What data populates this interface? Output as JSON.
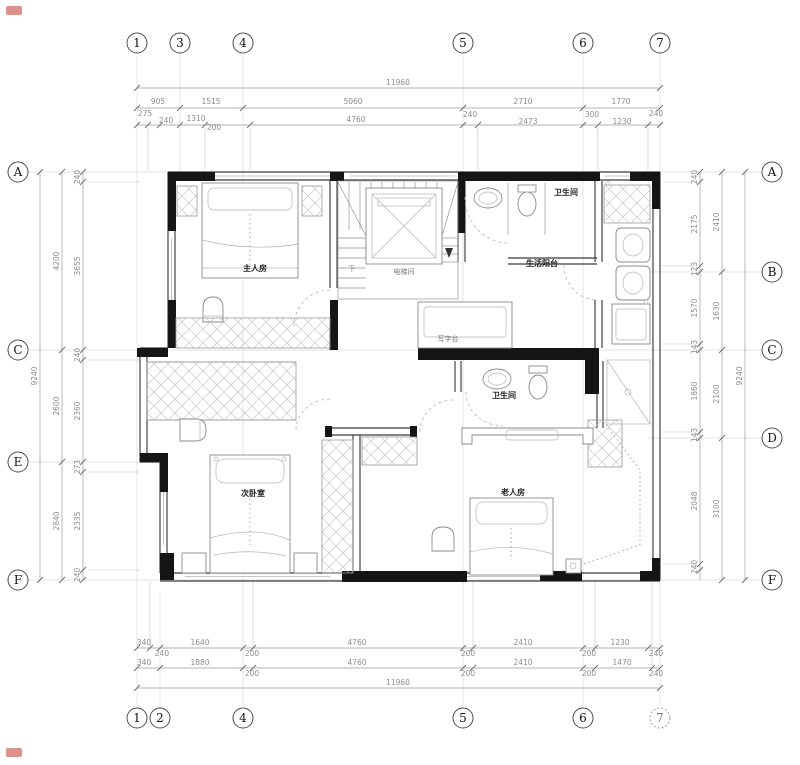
{
  "drawing_type": "residential floor plan (second storey)",
  "grid": {
    "top": [
      "1",
      "3",
      "4",
      "5",
      "6",
      "7"
    ],
    "bottom": [
      "1",
      "2",
      "4",
      "5",
      "6",
      "7"
    ],
    "left": [
      "A",
      "C",
      "E",
      "F"
    ],
    "right": [
      "A",
      "B",
      "C",
      "D",
      "F"
    ]
  },
  "rooms": {
    "master_bedroom": "主人房",
    "elevator": "电梯间",
    "bathroom_top": "卫生间",
    "service_balcony": "生活阳台",
    "desk_counter": "写字台",
    "bathroom_mid": "卫生间",
    "second_bedroom": "次卧室",
    "guest_bedroom": "老人房",
    "stair_direction": "下"
  },
  "dimensions": {
    "top": {
      "overall": "11960",
      "row2": [
        "905",
        "1515",
        "5060",
        "2710",
        "1770"
      ],
      "row3": [
        "275",
        "240",
        "1310",
        "200",
        "4760",
        "240",
        "2473",
        "300",
        "1230",
        "240"
      ]
    },
    "bottom": {
      "overall": "11960",
      "row1": [
        "340",
        "240",
        "1640",
        "200",
        "4760",
        "200",
        "2410",
        "200",
        "1230",
        "240"
      ],
      "row2": [
        "340",
        "1880",
        "200",
        "4760",
        "200",
        "2410",
        "200",
        "1470",
        "240"
      ]
    },
    "left": {
      "overall": "9240",
      "mid": [
        "4200",
        "2600",
        "2840"
      ],
      "inner": [
        "240",
        "3655",
        "240",
        "2360",
        "273",
        "2335",
        "240"
      ]
    },
    "right": {
      "overall": "9240",
      "mid": [
        "2410",
        "1630",
        "2100",
        "3100"
      ],
      "inner": [
        "240",
        "2175",
        "123",
        "1570",
        "143",
        "1860",
        "143",
        "2048",
        "240"
      ]
    }
  }
}
